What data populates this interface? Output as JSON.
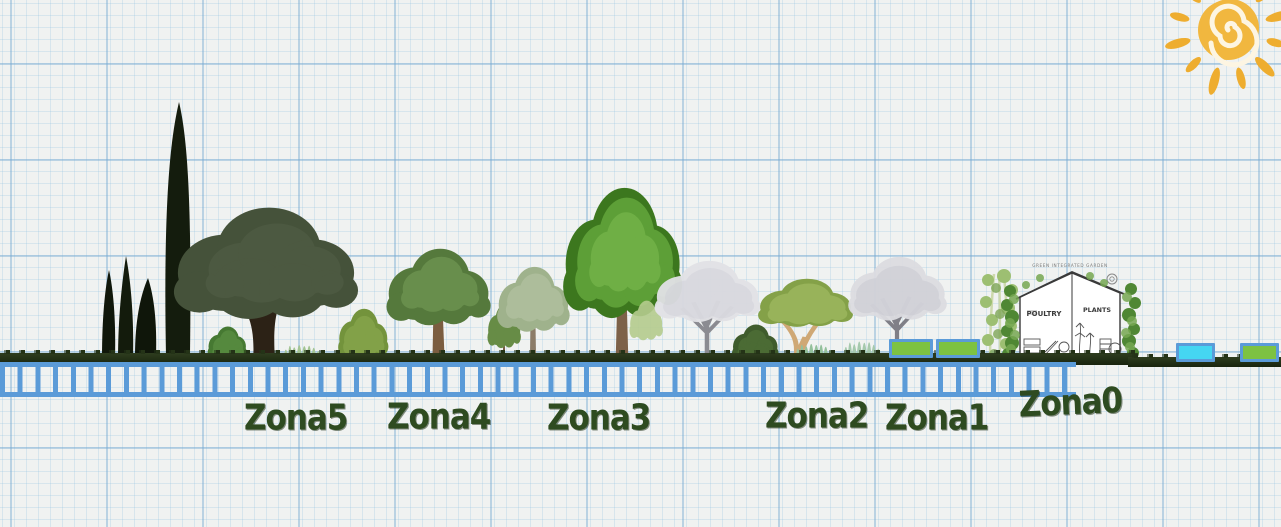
{
  "scene": {
    "type": "permaculture-zones-section-diagram",
    "paper": "graph-paper",
    "colors": {
      "paper": "#F0F2F1",
      "grid_line": "#BBD4E6",
      "ladder_blue": "#5B9BD8",
      "grass_dark": "#232F18",
      "zone_label_green": "#2E4B20",
      "sun_yellow": "#F1B73F",
      "bed_green": "#7DC242",
      "bed_cyan": "#45D6F2"
    },
    "elements": [
      "sun-spiral-icon",
      "cypress-trees",
      "oak-tree",
      "shrubs",
      "grass-tufts",
      "deciduous-trees",
      "blossom-trees",
      "raised-beds",
      "greenhouse-house",
      "hedge-strip",
      "ladder-scale"
    ]
  },
  "sun": {
    "icon": "sun-spiral-icon"
  },
  "zones": [
    {
      "id": "zone-5",
      "label": "Zona5"
    },
    {
      "id": "zone-4",
      "label": "Zona4"
    },
    {
      "id": "zone-3",
      "label": "Zona3"
    },
    {
      "id": "zone-2",
      "label": "Zona2"
    },
    {
      "id": "zone-1",
      "label": "Zona1"
    },
    {
      "id": "zone-0",
      "label": "Zona0"
    }
  ],
  "house": {
    "caption": "GREEN INTEGRATED GARDEN",
    "room_left": "POULTRY",
    "room_right": "PLANTS"
  }
}
